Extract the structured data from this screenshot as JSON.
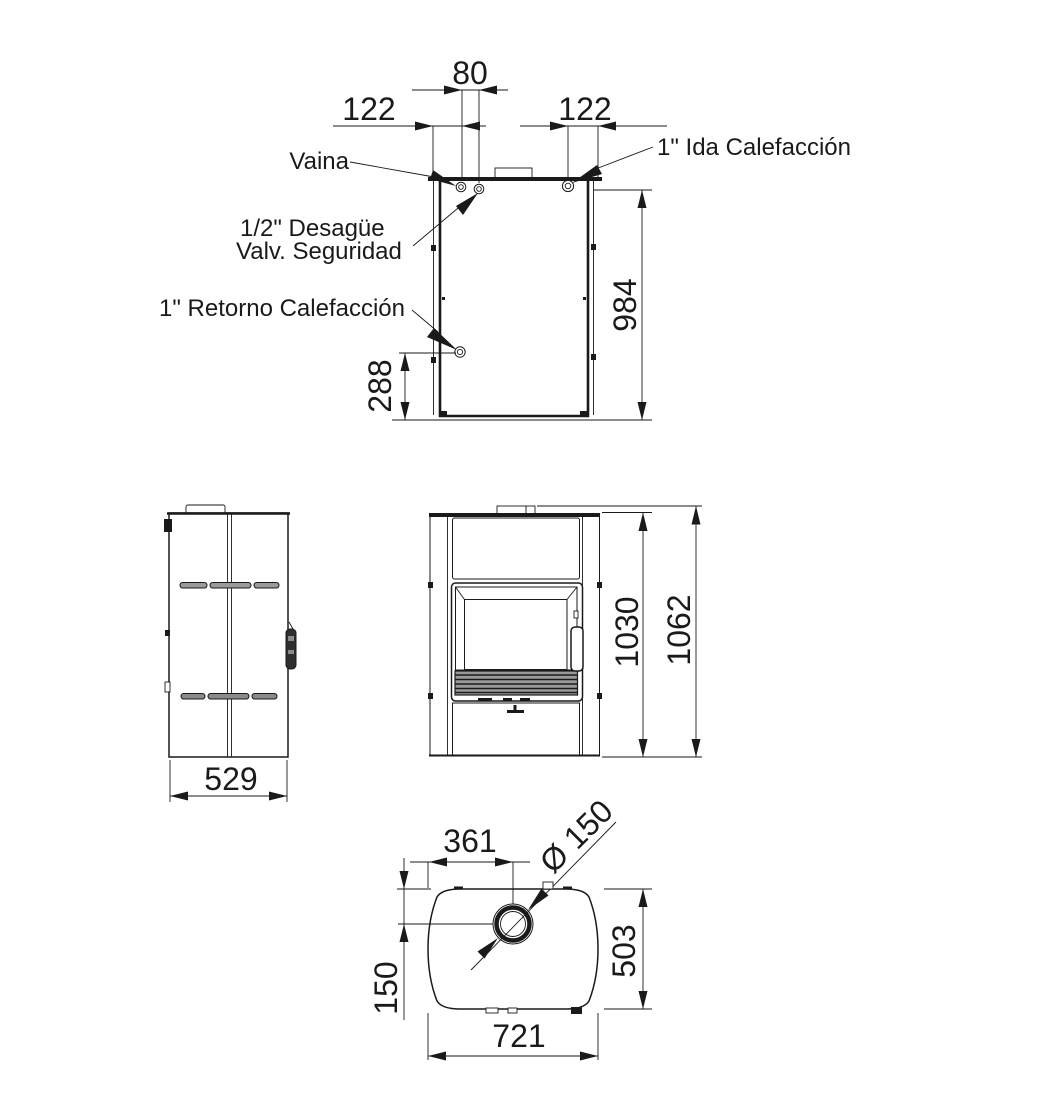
{
  "drawing": {
    "type": "technical-dimension-drawing",
    "units": "mm",
    "colors": {
      "line": "#1a1a1a",
      "background": "#ffffff"
    },
    "views": {
      "rear": {
        "labels": {
          "vaina": "Vaina",
          "desague_line1": "1/2\" Desagüe",
          "desague_line2": "Valv. Seguridad",
          "retorno": "1\" Retorno Calefacción",
          "ida": "1\" Ida Calefacción"
        },
        "dims": {
          "fitting_pitch": "80",
          "left_offset": "122",
          "right_offset": "122",
          "body_height": "984",
          "return_height": "288"
        }
      },
      "side": {
        "dims": {
          "depth": "529"
        }
      },
      "front": {
        "dims": {
          "body_height": "1030",
          "total_height": "1062"
        }
      },
      "plan": {
        "dims": {
          "flue_offset_x": "361",
          "flue_diameter": "Ø 150",
          "flue_offset_y": "150",
          "depth": "503",
          "width": "721"
        }
      }
    }
  }
}
